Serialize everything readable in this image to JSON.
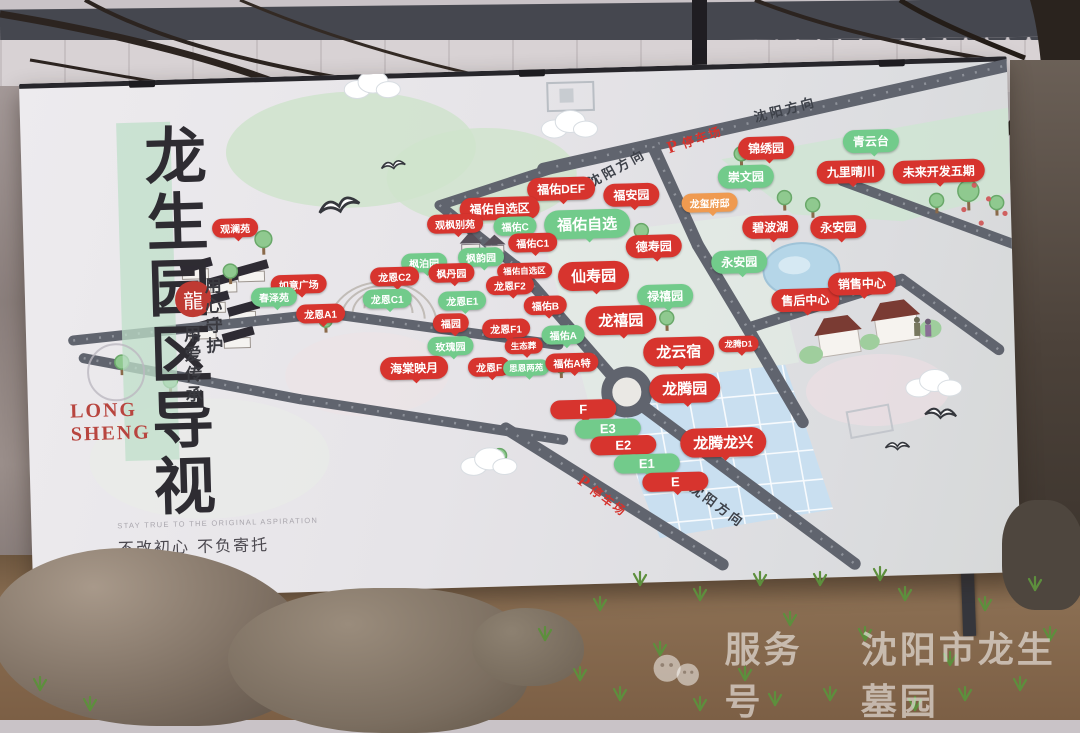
{
  "board": {
    "title_vertical": "龙生园区导视",
    "title_latin_line1": "LONG",
    "title_latin_line2": "SHENG",
    "seal": "龍",
    "motto_right": "用心守护",
    "motto_left": "用爱传承",
    "slogan_en": "STAY TRUE TO THE ORIGINAL ASPIRATION",
    "slogan_cn": "不改初心  不负寄托"
  },
  "map": {
    "colors": {
      "red": "#d7342e",
      "green": "#72cb8b",
      "orange": "#ef9a50",
      "road": "#60646e"
    },
    "road_texts": [
      {
        "text": "沈阳方向",
        "x": 595,
        "y": 100,
        "rot": -27
      },
      {
        "text": "沈阳方向",
        "x": 765,
        "y": 46,
        "rot": -13
      },
      {
        "text": "沈阳方向",
        "x": 687,
        "y": 440,
        "rot": 38
      }
    ],
    "parking_texts": [
      {
        "p": "P",
        "text": "停车场",
        "x": 674,
        "y": 74,
        "rot": -18
      },
      {
        "p": "P",
        "text": "停车场",
        "x": 572,
        "y": 428,
        "rot": 38
      }
    ],
    "labels": [
      {
        "t": "锦绣园",
        "x": 745,
        "y": 85,
        "c": "r",
        "s": "n"
      },
      {
        "t": "青云台",
        "x": 850,
        "y": 81,
        "c": "g",
        "s": "n"
      },
      {
        "t": "崇文园",
        "x": 724,
        "y": 113,
        "c": "g",
        "s": "n"
      },
      {
        "t": "九里晴川",
        "x": 829,
        "y": 111,
        "c": "r",
        "s": "n"
      },
      {
        "t": "未来开发五期",
        "x": 917,
        "y": 113,
        "c": "r",
        "s": "n"
      },
      {
        "t": "龙玺府邸",
        "x": 687,
        "y": 138,
        "c": "o",
        "s": "s"
      },
      {
        "t": "福佑DEF",
        "x": 539,
        "y": 120,
        "c": "r",
        "s": "n"
      },
      {
        "t": "福安园",
        "x": 609,
        "y": 128,
        "c": "r",
        "s": "n"
      },
      {
        "t": "碧波湖",
        "x": 747,
        "y": 164,
        "c": "r",
        "s": "n"
      },
      {
        "t": "永安园",
        "x": 815,
        "y": 166,
        "c": "r",
        "s": "n"
      },
      {
        "t": "福佑自选区",
        "x": 477,
        "y": 138,
        "c": "r",
        "s": "n"
      },
      {
        "t": "观枫别苑",
        "x": 432,
        "y": 152,
        "c": "r",
        "s": "s"
      },
      {
        "t": "观澜苑",
        "x": 212,
        "y": 150,
        "c": "r",
        "s": "s"
      },
      {
        "t": "福佑C",
        "x": 492,
        "y": 156,
        "c": "g",
        "s": "s"
      },
      {
        "t": "福佑自选",
        "x": 564,
        "y": 156,
        "c": "g",
        "s": "b"
      },
      {
        "t": "福佑C1",
        "x": 509,
        "y": 173,
        "c": "r",
        "s": "s"
      },
      {
        "t": "德寿园",
        "x": 630,
        "y": 180,
        "c": "r",
        "s": "n"
      },
      {
        "t": "枫泊园",
        "x": 400,
        "y": 190,
        "c": "g",
        "s": "s"
      },
      {
        "t": "枫韵园",
        "x": 457,
        "y": 186,
        "c": "g",
        "s": "s"
      },
      {
        "t": "龙恩C2",
        "x": 370,
        "y": 203,
        "c": "r",
        "s": "s"
      },
      {
        "t": "枫丹园",
        "x": 427,
        "y": 201,
        "c": "r",
        "s": "s"
      },
      {
        "t": "福佑自选区",
        "x": 500,
        "y": 201,
        "c": "r",
        "s": "t"
      },
      {
        "t": "仙寿园",
        "x": 569,
        "y": 208,
        "c": "r",
        "s": "b"
      },
      {
        "t": "永安园",
        "x": 715,
        "y": 198,
        "c": "g",
        "s": "n"
      },
      {
        "t": "禄禧园",
        "x": 640,
        "y": 230,
        "c": "g",
        "s": "n"
      },
      {
        "t": "如意广场",
        "x": 274,
        "y": 208,
        "c": "r",
        "s": "s"
      },
      {
        "t": "春泽苑",
        "x": 249,
        "y": 220,
        "c": "g",
        "s": "s"
      },
      {
        "t": "龙恩C1",
        "x": 362,
        "y": 225,
        "c": "g",
        "s": "s"
      },
      {
        "t": "龙恩E1",
        "x": 437,
        "y": 229,
        "c": "g",
        "s": "s"
      },
      {
        "t": "龙恩F2",
        "x": 485,
        "y": 215,
        "c": "r",
        "s": "s"
      },
      {
        "t": "福佑B",
        "x": 520,
        "y": 236,
        "c": "r",
        "s": "s"
      },
      {
        "t": "龙恩A1",
        "x": 295,
        "y": 238,
        "c": "r",
        "s": "s"
      },
      {
        "t": "福园",
        "x": 425,
        "y": 251,
        "c": "r",
        "s": "s"
      },
      {
        "t": "龙恩F1",
        "x": 480,
        "y": 258,
        "c": "r",
        "s": "s"
      },
      {
        "t": "龙禧园",
        "x": 595,
        "y": 253,
        "c": "r",
        "s": "b"
      },
      {
        "t": "福佑A",
        "x": 537,
        "y": 266,
        "c": "g",
        "s": "s"
      },
      {
        "t": "玫瑰园",
        "x": 424,
        "y": 274,
        "c": "g",
        "s": "s"
      },
      {
        "t": "生态葬",
        "x": 497,
        "y": 276,
        "c": "r",
        "s": "t"
      },
      {
        "t": "海棠映月",
        "x": 387,
        "y": 295,
        "c": "r",
        "s": "n"
      },
      {
        "t": "龙恩F",
        "x": 462,
        "y": 296,
        "c": "r",
        "s": "s"
      },
      {
        "t": "思恩两苑",
        "x": 499,
        "y": 298,
        "c": "g",
        "s": "t"
      },
      {
        "t": "福佑A特",
        "x": 545,
        "y": 294,
        "c": "r",
        "s": "s"
      },
      {
        "t": "龙云宿",
        "x": 652,
        "y": 286,
        "c": "r",
        "s": "b"
      },
      {
        "t": "龙腾D1",
        "x": 712,
        "y": 280,
        "c": "r",
        "s": "t"
      },
      {
        "t": "售后中心",
        "x": 780,
        "y": 238,
        "c": "r",
        "s": "n"
      },
      {
        "t": "销售中心",
        "x": 837,
        "y": 223,
        "c": "r",
        "s": "n"
      },
      {
        "t": "龙腾园",
        "x": 657,
        "y": 323,
        "c": "r",
        "s": "b"
      },
      {
        "t": "F",
        "x": 555,
        "y": 341,
        "c": "r",
        "s": "w"
      },
      {
        "t": "E3",
        "x": 579,
        "y": 361,
        "c": "g",
        "s": "w"
      },
      {
        "t": "E2",
        "x": 594,
        "y": 378,
        "c": "r",
        "s": "w"
      },
      {
        "t": "E1",
        "x": 617,
        "y": 397,
        "c": "g",
        "s": "w"
      },
      {
        "t": "E",
        "x": 645,
        "y": 416,
        "c": "r",
        "s": "w"
      },
      {
        "t": "龙腾龙兴",
        "x": 694,
        "y": 378,
        "c": "r",
        "s": "b"
      }
    ]
  },
  "watermark": {
    "account_label": "服务号",
    "account_name": "沈阳市龙生墓园"
  }
}
